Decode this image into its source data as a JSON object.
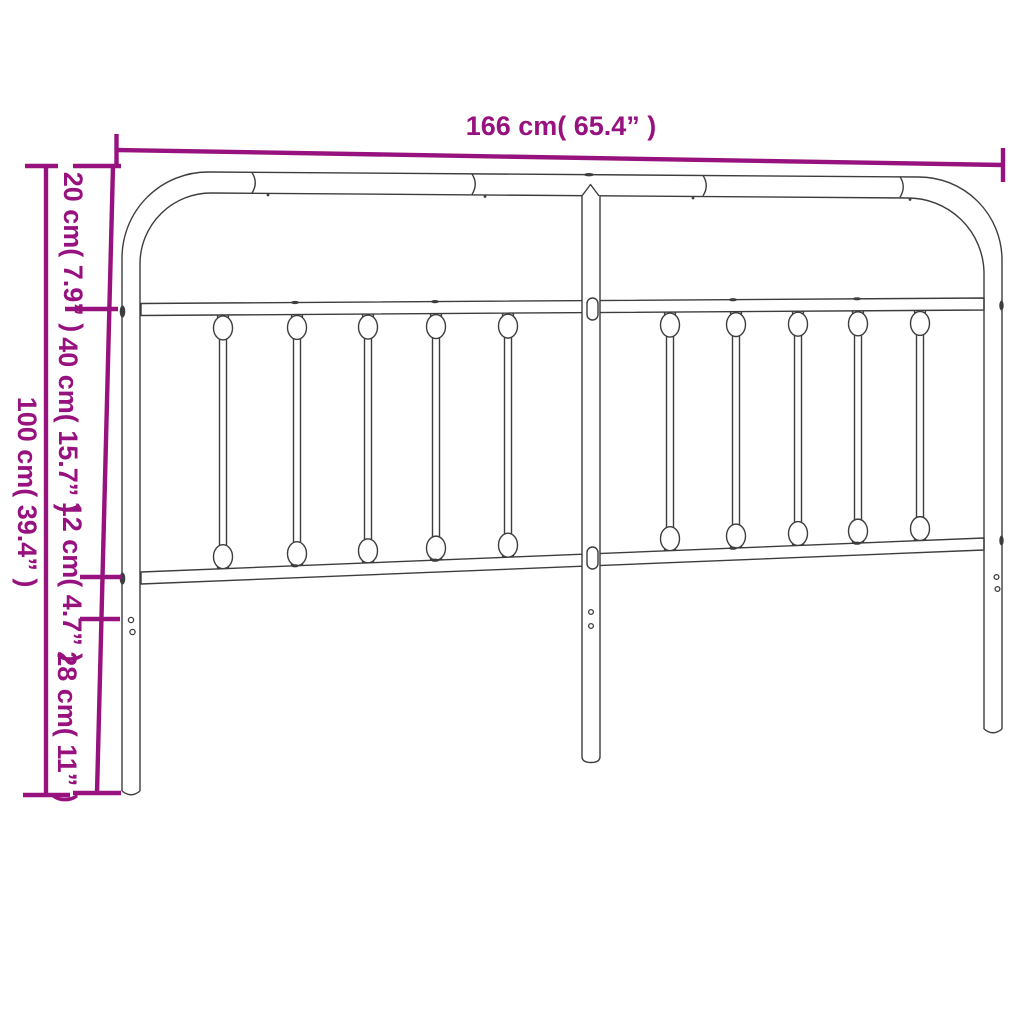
{
  "title": "Metal headboard dimension diagram",
  "colors": {
    "dimension_annotation": "#97127F",
    "drawing_line": "#3d3d3d",
    "background": "#ffffff"
  },
  "dimensions": {
    "top_width_label": "166 cm( 65.4” )",
    "total_height_label": "100 cm( 39.4” )",
    "segment_labels_top_to_bottom": [
      "20 cm( 7.9” )",
      "40 cm( 15.7” )",
      "12 cm( 4.7” )",
      "28 cm( 11” )"
    ]
  }
}
